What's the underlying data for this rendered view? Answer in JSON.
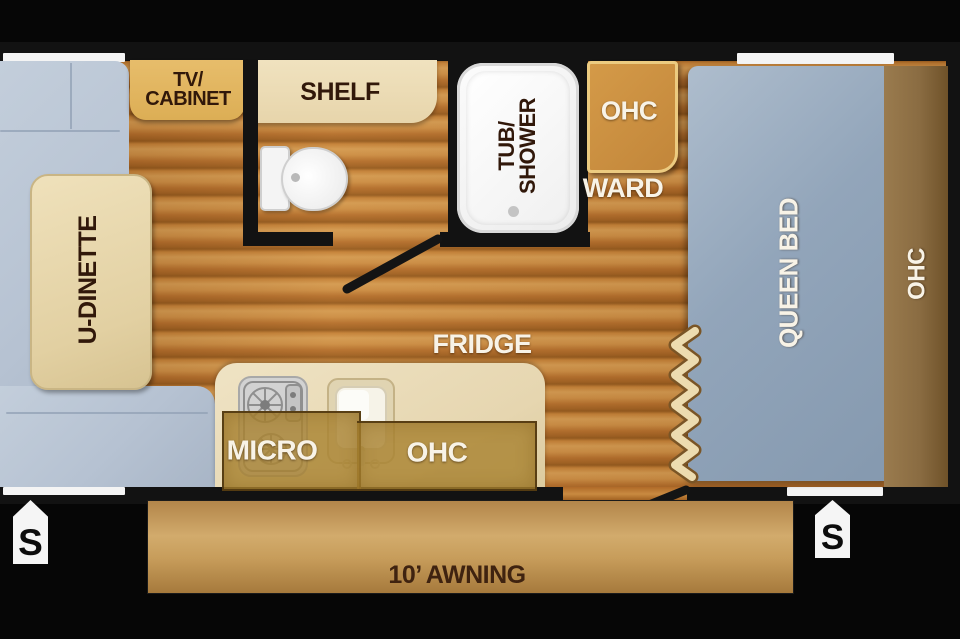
{
  "floorplan": {
    "living": {
      "dinette_label": "U-DINETTE",
      "tv_cabinet_line1": "TV/",
      "tv_cabinet_line2": "CABINET"
    },
    "bath": {
      "shelf_label": "SHELF",
      "tub_line1": "TUB/",
      "tub_line2": "SHOWER"
    },
    "bedroom": {
      "ohc_cabinet_label": "OHC",
      "wardrobe_label": "WARD",
      "bed_label": "QUEEN BED",
      "ohc_side_label": "OHC"
    },
    "kitchen": {
      "fridge_label": "FRIDGE",
      "micro_label": "MICRO",
      "ohc_label": "OHC"
    },
    "exterior": {
      "awning_label": "10’ AWNING",
      "speaker_left": "S",
      "speaker_right": "S"
    },
    "colors": {
      "background": "#060606",
      "wall": "#121212",
      "floor_wood": "#b06a28",
      "sofa": "#b6c2d2",
      "table": "#e2d0a2",
      "cabinet_tan": "#dcae55",
      "cabinet_cream": "#e7d5ab",
      "cabinet_amber": "#c2863a",
      "bed": "#92a5ba",
      "bed_ohc": "#8a6c42",
      "counter": "#e6d6b0",
      "overlay": "#aa8432",
      "awning": "#c79d5b",
      "label_dark": "#31180a",
      "label_light": "#f8f3e7"
    }
  }
}
